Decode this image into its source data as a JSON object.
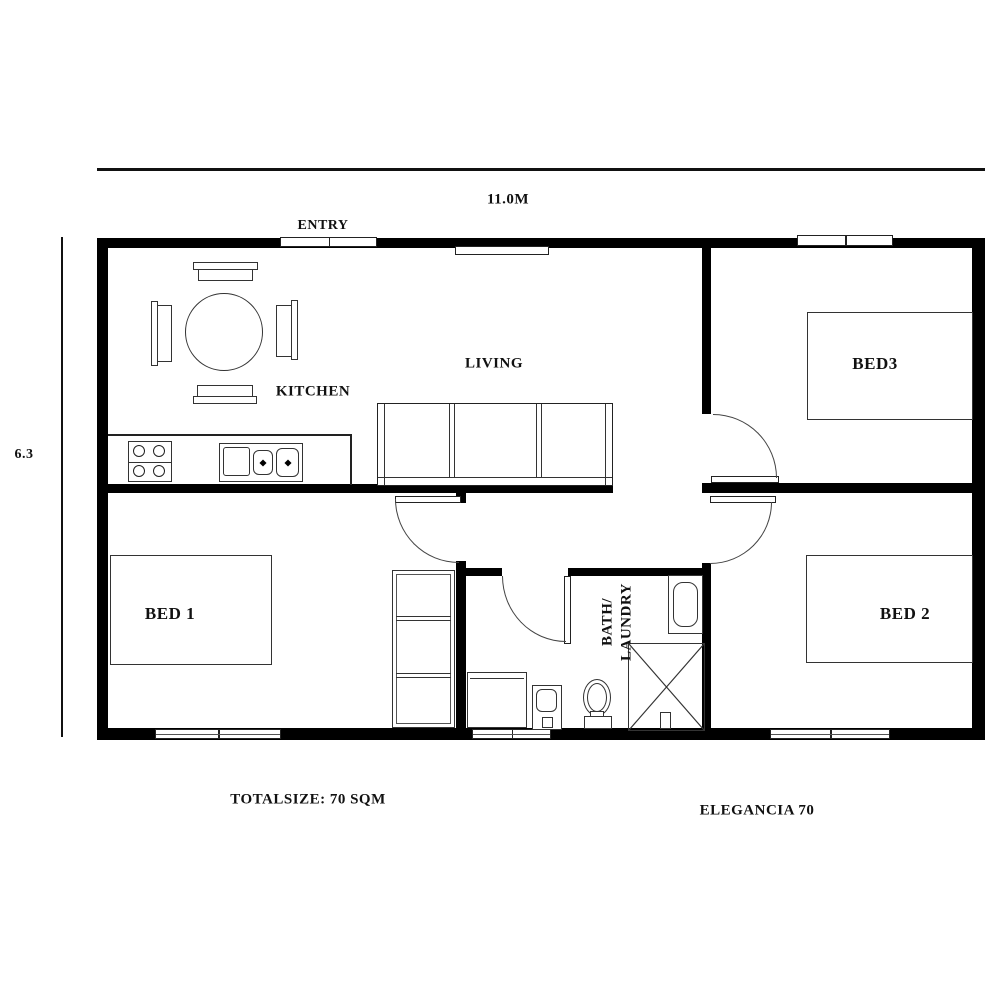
{
  "plan": {
    "model_name": "ELEGANCIA 70",
    "total_size": "TOTALSIZE: 70 SQM",
    "dimension_width": "11.0M",
    "dimension_height": "6.3"
  },
  "rooms": {
    "entry": "ENTRY",
    "kitchen": "KITCHEN",
    "living": "LIVING",
    "bed1": "BED 1",
    "bed2": "BED 2",
    "bed3": "BED3",
    "bath_line1": "BATH/",
    "bath_line2": "LAUNDRY"
  },
  "symbols": {
    "dining_table": "round-dining-table",
    "chairs": "dining-chair",
    "cooktop": "four-burner-cooktop",
    "sink": "double-kitchen-sink",
    "sofa": "three-seat-sofa",
    "bed": "double-bed",
    "shelf": "shelf-unit",
    "bathtub": "bathtub",
    "shower": "shower-cubicle",
    "washer": "washing-machine",
    "toilet": "toilet",
    "basin": "pedestal-basin",
    "door_arc": "door-swing",
    "window": "window"
  },
  "colors": {
    "wall": "#000000",
    "furniture_line": "#333333",
    "text": "#111111",
    "background": "#ffffff"
  }
}
